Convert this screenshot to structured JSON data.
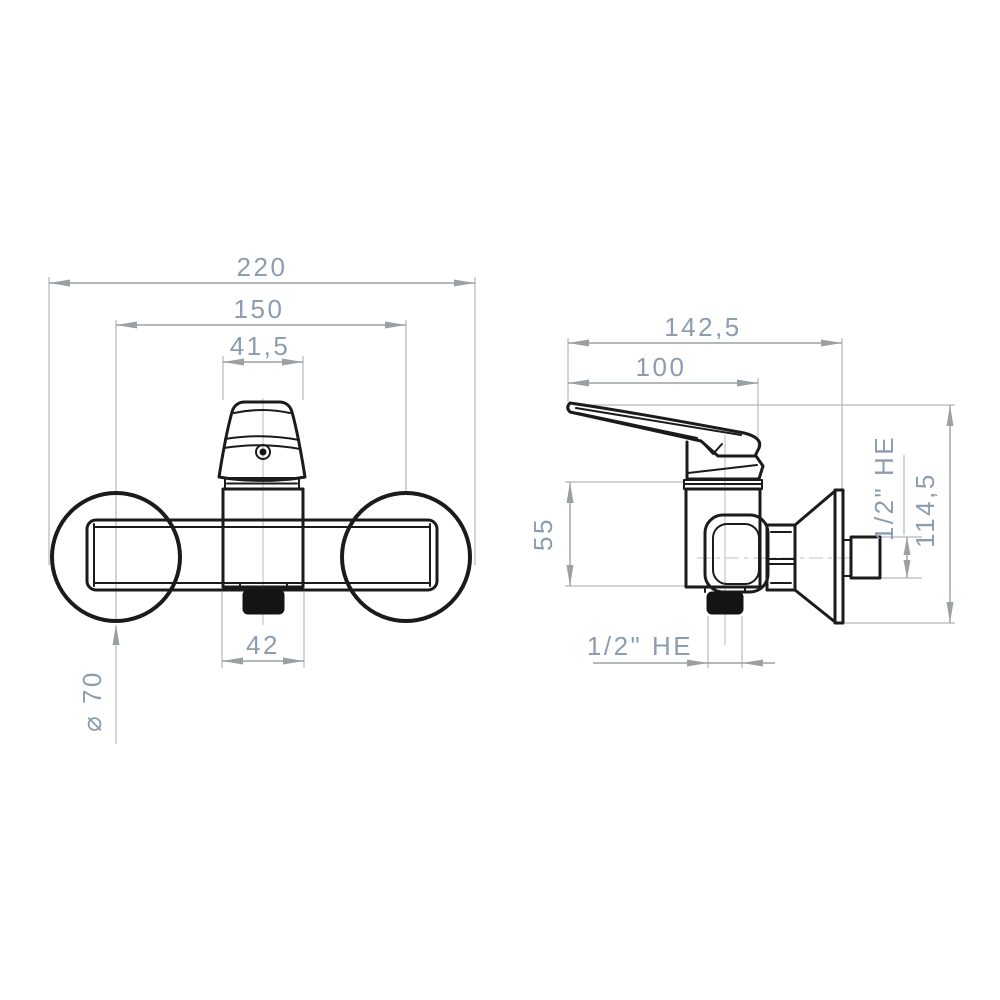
{
  "drawing": {
    "background": "#ffffff",
    "object_line_color": "#1b1b1b",
    "dimension_line_color": "#9aa0a4",
    "label_color": "#8d9db0",
    "front_view": {
      "overall_width": "220",
      "connection_centers_width": "150",
      "body_width": "41,5",
      "outlet_width": "42",
      "escutcheon_diameter": "⌀ 70"
    },
    "side_view": {
      "overall_depth": "142,5",
      "handle_depth": "100",
      "body_height": "55",
      "overall_height": "114,5",
      "inlet_thread": "1/2\" HE",
      "outlet_thread": "1/2\" HE"
    }
  }
}
